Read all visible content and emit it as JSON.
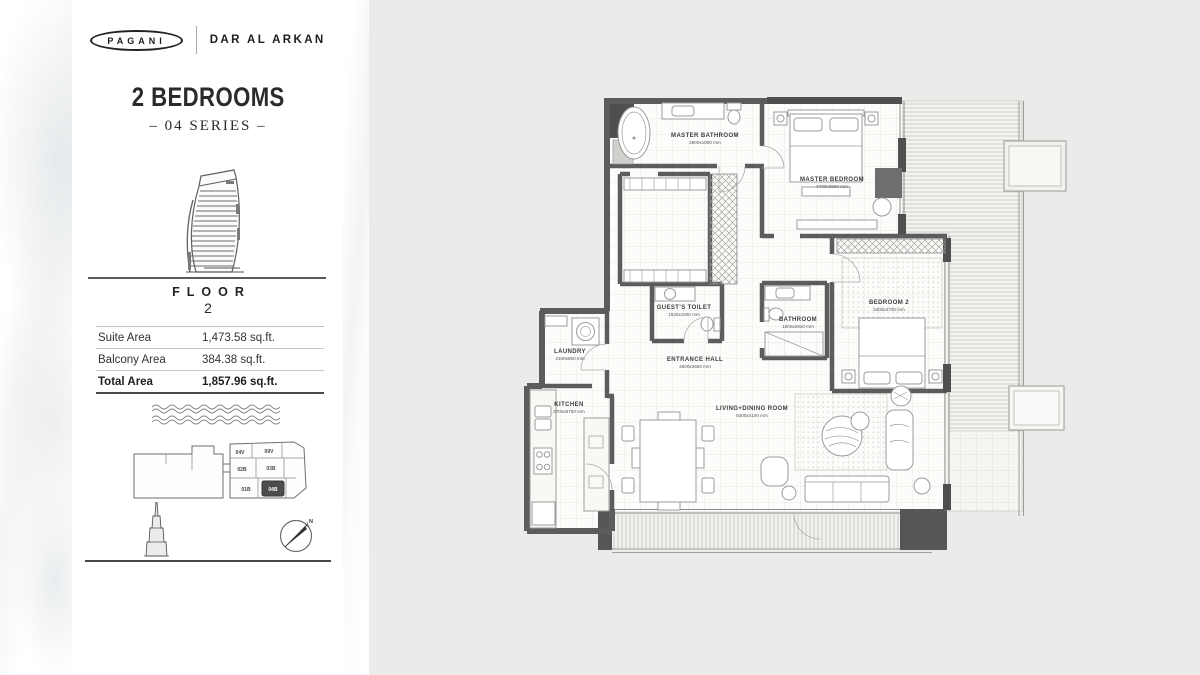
{
  "brand": {
    "pagani_logo": "PAGANI",
    "partner": "DAR AL ARKAN"
  },
  "plan_header": {
    "title": "2 BEDROOMS",
    "series": "– 04 SERIES –"
  },
  "floor_indicator": {
    "label": "FLOOR",
    "number": "2"
  },
  "area_table": {
    "rows": [
      {
        "label": "Suite Area",
        "value": "1,473.58 sq.ft."
      },
      {
        "label": "Balcony Area",
        "value": "384.38 sq.ft."
      },
      {
        "label": "Total Area",
        "value": "1,857.96 sq.ft."
      }
    ]
  },
  "key_plan": {
    "units": [
      "04V",
      "09V",
      "02B",
      "03B",
      "01B"
    ],
    "highlighted_unit": "04B"
  },
  "compass": {
    "north": "N"
  },
  "floor_plan": {
    "rooms": [
      {
        "name": "MASTER BATHROOM",
        "dims": "3900x1800 mm"
      },
      {
        "name": "MASTER BEDROOM",
        "dims": "4700x3900 mm"
      },
      {
        "name": "GUEST'S TOILET",
        "dims": "1530x1500 mm"
      },
      {
        "name": "BATHROOM",
        "dims": "1800x2910 mm"
      },
      {
        "name": "BEDROOM 2",
        "dims": "3400x4700 mm"
      },
      {
        "name": "ENTRANCE HALL",
        "dims": "4600x3650 mm"
      },
      {
        "name": "LAUNDRY",
        "dims": "2100x850 mm"
      },
      {
        "name": "KITCHEN",
        "dims": "2700x5750 mm"
      },
      {
        "name": "LIVING+DINING ROOM",
        "dims": "9200x4100 mm"
      }
    ]
  },
  "colors": {
    "panel_bg": "#ebebe9",
    "wall": "#5c5c5c",
    "dark_wall": "#4f4f4f",
    "highlight_unit": "#4c4c4c"
  }
}
